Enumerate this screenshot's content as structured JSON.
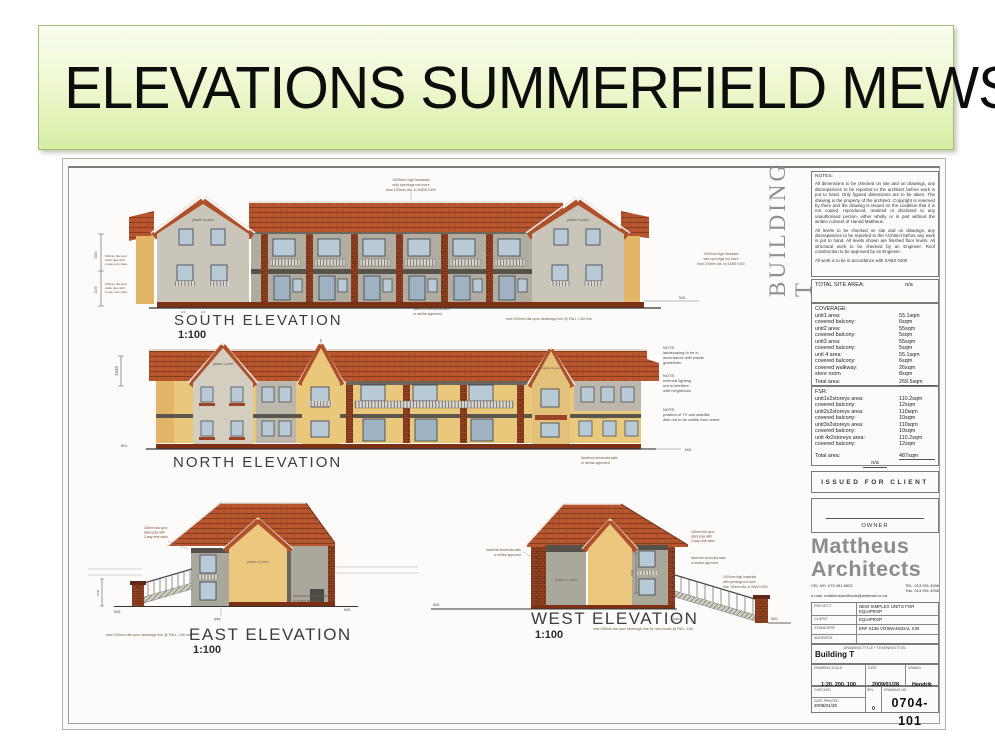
{
  "slide": {
    "title": "ELEVATIONS SUMMERFIELD MEWS"
  },
  "sheet": {
    "building_label": "BUILDING T",
    "common_notes": {
      "handrail": [
        "1000mm high handrails",
        "with openings not more",
        "than 100mm dia. to SABS 0400"
      ],
      "facebrick": [
        "facebrick terracotta satin",
        "or similar approved"
      ],
      "stack_pipe": [
        "100mm dia upvc",
        "stack pipe with",
        "2-way vent valve"
      ],
      "plaster_paint": "plaster & paint",
      "ngl": "NGL",
      "gully": "gully",
      "fall_mark": "1:6"
    },
    "south": {
      "label": "SOUTH ELEVATION",
      "scale": "1:100",
      "sewer_note": "new 100mm dia upvc sewerage line @ FALL 1:60 min",
      "dims": [
        "2500",
        "2135"
      ]
    },
    "north": {
      "label": "NORTH ELEVATION",
      "dim": "1540",
      "notes": [
        [
          "NOTE:",
          "landscaping to be in",
          "accordance with estate",
          "guidelines"
        ],
        [
          "NOTE:",
          "external lighting",
          "not to interfere",
          "with neighbours"
        ],
        [
          "NOTE:",
          "position of TV and satellite",
          "dish not to be visible from street"
        ]
      ]
    },
    "east": {
      "label": "EAST ELEVATION",
      "scale": "1:100",
      "sewer_note": "new 100mm dia upvc sewerage line @ FALL 1:60 min",
      "dim": "1540"
    },
    "west": {
      "label": "WEST ELEVATION",
      "scale": "1:100",
      "sewer_note": "new 100mm dia upvc sewerage line for new house @ FALL 1:60",
      "dim": "2500"
    }
  },
  "titleblock": {
    "notes_title": "NOTES:",
    "notes_p1": "All dimensions to be checked on site and on drawings, any discrepancies to be reported to the architect before work is put to hand. Only figured dimensions are to be taken. The drawing is the property of the architect. Copyright is reserved by them and the drawing is issued on the condition that it is not copied, reproduced, retained or disclosed to any unauthorised person, either wholly or in part without the written consent of Harold Mattheus.",
    "notes_p2": "All levels to be checked on site and on drawings, any discrepancies to be reported to the Architect before any work is put to hand. All levels shown are finished floor levels. All structural work to be checked by an Engineer. Roof construction to be approved by an Engineer.",
    "notes_p3": "All work is to be in accordance with SABS 0400",
    "total_site": {
      "label": "TOTAL SITE AREA:",
      "value": "n/a"
    },
    "coverage": {
      "title": "COVERAGE:",
      "rows": [
        {
          "label": "unit1 area:",
          "value": "55.1sqm"
        },
        {
          "label": "covered balcony:",
          "value": "6sqm"
        },
        {
          "label": "unit2 area:",
          "value": "55sqm"
        },
        {
          "label": "covered balcony:",
          "value": "5sqm"
        },
        {
          "label": "unit3 area:",
          "value": "55sqm"
        },
        {
          "label": "covered balcony:",
          "value": "5sqm"
        },
        {
          "label": "unit 4 area:",
          "value": "55.1sqm"
        },
        {
          "label": "covered balcony:",
          "value": "6sqm"
        },
        {
          "label": "covered walkway:",
          "value": "26sqm"
        },
        {
          "label": "store room",
          "value": "8sqm"
        },
        {
          "label": "Total area:",
          "value": "269.5sqm"
        }
      ]
    },
    "fsr": {
      "title": "FSR:",
      "rows": [
        {
          "label": "unit1x2storeys area:",
          "value": "110.2sqm"
        },
        {
          "label": "covered balcony:",
          "value": "12sqm"
        },
        {
          "label": "unit2x2storeys area:",
          "value": "110sqm"
        },
        {
          "label": "covered balcony:",
          "value": "10sqm"
        },
        {
          "label": "unit3x2storeys area:",
          "value": "110sqm"
        },
        {
          "label": "covered balcony:",
          "value": "10sqm"
        },
        {
          "label": "unit 4x2storeys area:",
          "value": "110.2sqm"
        },
        {
          "label": "covered balcony:",
          "value": "12sqm"
        }
      ],
      "total_label": "Total area:",
      "total_value": "487sqm",
      "na": "n/a"
    },
    "issued": "ISSUED FOR CLIENT",
    "owner": "OWNER",
    "firm_line1": "Mattheus",
    "firm_line2": "Architects",
    "contact": {
      "cel": "CEL NO. 073 491 8823",
      "tel": "TEL. 013 931 4936",
      "fax": "Fax. 013 931 4936",
      "email": "e-mail. mattheusarchitects@webmail.co.za"
    },
    "project": {
      "rows": [
        {
          "label": "PROJECT",
          "value": "NEW SIMPLEX UNITS FOR EQUIPROP"
        },
        {
          "label": "CLIENT",
          "value": "EQUIPROP"
        },
        {
          "label": "STAND/ERF",
          "value": "ERF 6136 VOSMANSDAL X30"
        },
        {
          "label": "ADDRESS",
          "value": ""
        }
      ]
    },
    "drawing_title": {
      "label": "DRAWING TITLE * TEKENINGTITEL",
      "value": "Building T"
    },
    "scale_row": {
      "scale_label": "DRAWING SCALE",
      "scale": "1:20, 200, 100",
      "date_label": "DATE",
      "date": "2009/01/28",
      "drawn_label": "DRAWN",
      "drawn": "Hendrik"
    },
    "bottom_row": {
      "checked_label": "CHECKED",
      "printed_label": "DATE PRINTED",
      "printed": "2009/01/28",
      "rev_label": "REV",
      "rev": "0",
      "no_label": "DRAWING NO",
      "number": "0704-101"
    }
  }
}
